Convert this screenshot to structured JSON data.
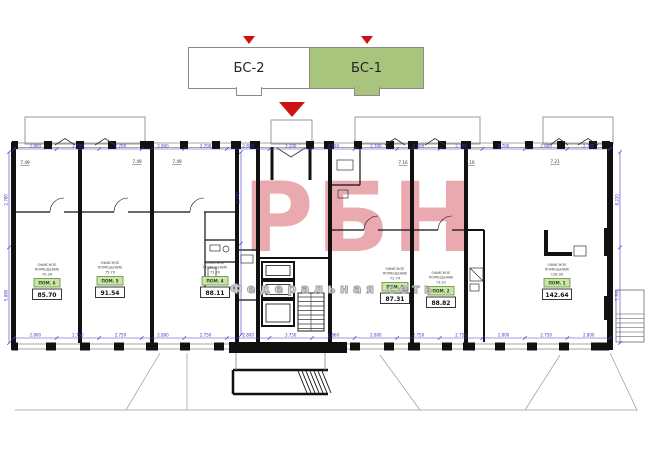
{
  "selector": {
    "blocks": [
      {
        "label": "БС-2",
        "active": false
      },
      {
        "label": "БС-1",
        "active": true
      }
    ]
  },
  "watermark": {
    "logo": "РБН",
    "tagline": "Федеральная сеть"
  },
  "colors": {
    "accent_green": "#a9c47d",
    "badge_green": "#cde6a8",
    "badge_border": "#5f8f3f",
    "arrow_red": "#cc1111",
    "watermark_pink": "#d9545e",
    "dim_blue": "#3a3ac8"
  },
  "plan": {
    "rooms": [
      {
        "unit": "ПОМ. 6",
        "type": "ОФИСНОЕ ПОМЕЩЕНИЕ",
        "room_area": "70.34",
        "total_area": "85.70"
      },
      {
        "unit": "ПОМ. 5",
        "type": "ОФИСНОЕ ПОМЕЩЕНИЕ",
        "room_area": "75.70",
        "total_area": "91.54"
      },
      {
        "unit": "ПОМ. 4",
        "type": "ОФИСНОЕ ПОМЕЩЕНИЕ",
        "room_area": "73.20",
        "total_area": "88.11"
      },
      {
        "unit": "ПОМ. 3",
        "type": "ОФИСНОЕ ПОМЕЩЕНИЕ",
        "room_area": "72.74",
        "total_area": "87.31"
      },
      {
        "unit": "ПОМ. 2",
        "type": "ОФИСНОЕ ПОМЕЩЕНИЕ",
        "room_area": "73.91",
        "total_area": "88.82"
      },
      {
        "unit": "ПОМ. 1",
        "type": "ОФИСНОЕ ПОМЕЩЕНИЕ",
        "room_area": "128.00",
        "total_area": "142.64"
      }
    ],
    "balcony_areas": [
      "7.49",
      "7.49",
      "7.49",
      "7.16",
      "7.16",
      "7.21"
    ],
    "dims_top": [
      "2.800",
      "2.700",
      "2.700",
      "2.800",
      "2.700",
      "2.800",
      "3.200",
      "2.800",
      "2.700",
      "2.800",
      "2.700",
      "2.700",
      "2.800",
      "2.700"
    ],
    "dims_bottom": [
      "2.800",
      "2.750",
      "2.750",
      "2.800",
      "2.750",
      "2.800",
      "3.750",
      "2.860",
      "2.800",
      "2.750",
      "2.750",
      "2.800",
      "2.750",
      "2.800"
    ],
    "dims_left": [
      "2.780",
      "5.880"
    ],
    "dims_right": [
      "8.220",
      "7.705"
    ],
    "dims_inner": [
      "2.770",
      "4.420"
    ]
  }
}
